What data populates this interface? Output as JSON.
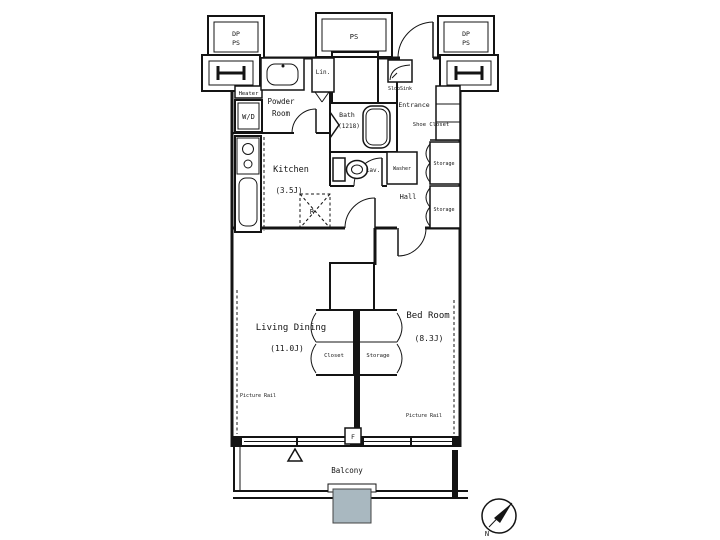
{
  "colors": {
    "shaft_fill": "#a9b8c0",
    "wall": "#141414",
    "background": "#ffffff"
  },
  "shafts": {
    "corner_line1": "DP",
    "corner_line2": "PS",
    "center": "PS"
  },
  "rooms": {
    "powder_room": {
      "line1": "Powder",
      "line2": "Room"
    },
    "kitchen": {
      "name": "Kitchen",
      "size": "(3.5J)"
    },
    "bath": {
      "name": "Bath",
      "size": "(1218)"
    },
    "lav": {
      "name": "Lav."
    },
    "hall": {
      "name": "Hall"
    },
    "entrance": {
      "name": "Entrance"
    },
    "living_dining": {
      "name": "Living Dining",
      "size": "(11.0J)"
    },
    "bed_room": {
      "name": "Bed Room",
      "size": "(8.3J)"
    },
    "balcony": {
      "name": "Balcony"
    }
  },
  "storage": {
    "linen": "Lin.",
    "shoe_closet": "Shoe Closet",
    "hall_storage_upper": "Storage",
    "hall_storage_lower": "Storage",
    "closet": "Closet",
    "bedroom_storage": "Storage"
  },
  "fixtures": {
    "heater": "Heater",
    "washer_dryer": "W/D",
    "washer": "Washer",
    "refrigerator": "R",
    "slop_sink": "SlopSink",
    "floor_hatch": "F"
  },
  "annotations": {
    "picture_rail_living": "Picture Rail",
    "picture_rail_bedroom": "Picture Rail",
    "compass_north": "N"
  }
}
